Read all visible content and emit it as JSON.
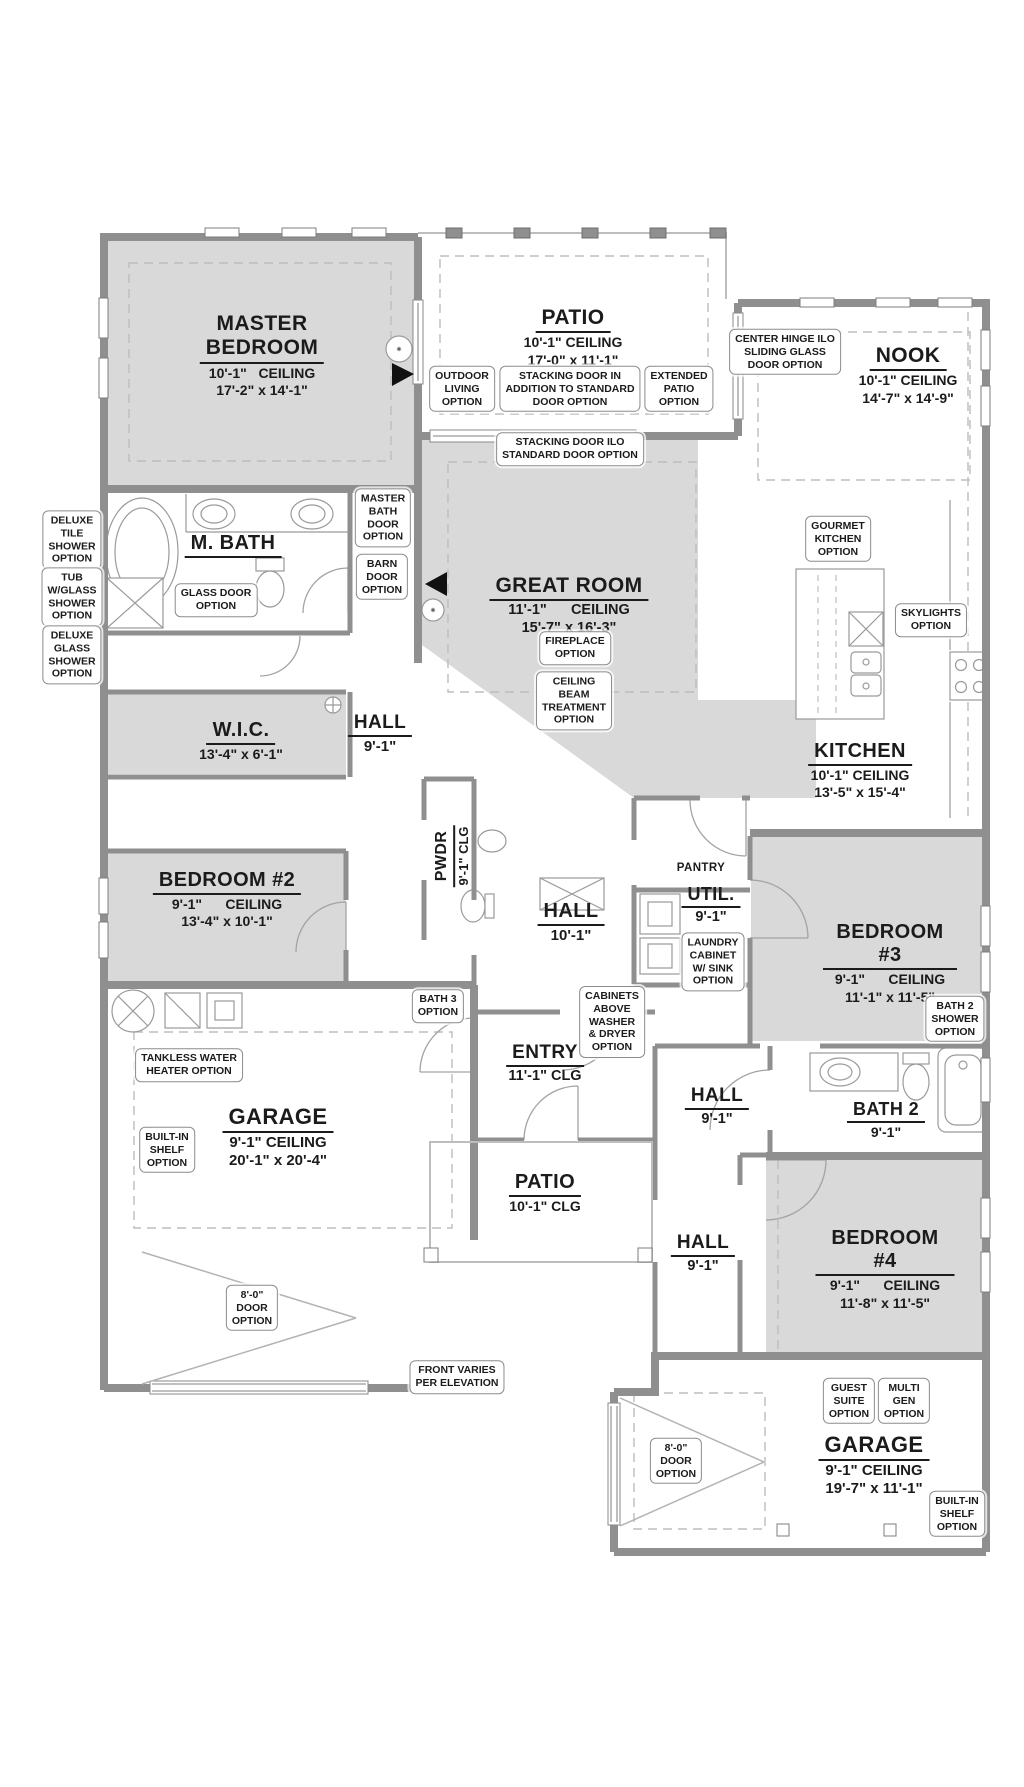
{
  "colors": {
    "wall": "#8f8f8f",
    "room_fill": "#d9d9d9",
    "dash": "#bdbdbd",
    "text": "#1b1b1b"
  },
  "plan": {
    "rooms": [
      {
        "id": "master-bedroom",
        "title": "MASTER\nBEDROOM",
        "lines": [
          "10'-1\"   CEILING",
          "17'-2\" x 14'-1\""
        ]
      },
      {
        "id": "patio-top",
        "title": "PATIO",
        "lines": [
          "10'-1\" CEILING",
          "17'-0\" x 11'-1\""
        ]
      },
      {
        "id": "nook",
        "title": "NOOK",
        "lines": [
          "10'-1\" CEILING",
          "14'-7\" x 14'-9\""
        ]
      },
      {
        "id": "m-bath",
        "title": "M. BATH",
        "lines": []
      },
      {
        "id": "great-room",
        "title": "GREAT ROOM",
        "lines": [
          "11'-1\"      CEILING",
          "15'-7\" x 16'-3\""
        ]
      },
      {
        "id": "kitchen",
        "title": "KITCHEN",
        "lines": [
          "10'-1\" CEILING",
          "13'-5\" x 15'-4\""
        ]
      },
      {
        "id": "wic",
        "title": "W.I.C.",
        "lines": [
          "13'-4\" x 6'-1\""
        ]
      },
      {
        "id": "hall-upper",
        "title": "HALL",
        "lines": [
          "9'-1\""
        ]
      },
      {
        "id": "bedroom-2",
        "title": "BEDROOM #2",
        "lines": [
          "9'-1\"      CEILING",
          "13'-4\" x 10'-1\""
        ]
      },
      {
        "id": "pwdr",
        "title": "PWDR",
        "lines": [
          "9'-1\" CLG"
        ],
        "rot": true
      },
      {
        "id": "hall-center",
        "title": "HALL",
        "lines": [
          "10'-1\""
        ]
      },
      {
        "id": "pantry",
        "title": "PANTRY",
        "lines": [],
        "plain": true
      },
      {
        "id": "util",
        "title": "UTIL.",
        "lines": [
          "9'-1\""
        ]
      },
      {
        "id": "bedroom-3",
        "title": "BEDROOM #3",
        "lines": [
          "9'-1\"      CEILING",
          "11'-1\" x 11'-5\""
        ]
      },
      {
        "id": "garage-main",
        "title": "GARAGE",
        "lines": [
          "9'-1\" CEILING",
          "20'-1\" x 20'-4\""
        ]
      },
      {
        "id": "entry",
        "title": "ENTRY",
        "lines": [
          "11'-1\" CLG"
        ]
      },
      {
        "id": "hall-bath2",
        "title": "HALL",
        "lines": [
          "9'-1\""
        ]
      },
      {
        "id": "bath-2",
        "title": "BATH 2",
        "lines": [
          "9'-1\""
        ]
      },
      {
        "id": "patio-front",
        "title": "PATIO",
        "lines": [
          "10'-1\" CLG"
        ]
      },
      {
        "id": "hall-bedroom4",
        "title": "HALL",
        "lines": [
          "9'-1\""
        ]
      },
      {
        "id": "bedroom-4",
        "title": "BEDROOM #4",
        "lines": [
          "9'-1\"      CEILING",
          "11'-8\" x 11'-5\""
        ]
      },
      {
        "id": "garage-rear",
        "title": "GARAGE",
        "lines": [
          "9'-1\" CEILING",
          "19'-7\" x 11'-1\""
        ]
      }
    ],
    "callouts": [
      {
        "id": "outdoor-living",
        "text": "OUTDOOR\nLIVING\nOPTION"
      },
      {
        "id": "stacking-door-addition",
        "text": "STACKING DOOR IN\nADDITION TO STANDARD\nDOOR OPTION"
      },
      {
        "id": "extended-patio",
        "text": "EXTENDED\nPATIO\nOPTION"
      },
      {
        "id": "center-hinge",
        "text": "CENTER HINGE ILO\nSLIDING GLASS\nDOOR OPTION"
      },
      {
        "id": "stacking-door-ilo",
        "text": "STACKING DOOR ILO\nSTANDARD DOOR OPTION"
      },
      {
        "id": "deluxe-tile-shower",
        "text": "DELUXE\nTILE\nSHOWER\nOPTION"
      },
      {
        "id": "tub-glass-shower",
        "text": "TUB\nW/GLASS\nSHOWER\nOPTION"
      },
      {
        "id": "deluxe-glass-shower",
        "text": "DELUXE\nGLASS\nSHOWER\nOPTION"
      },
      {
        "id": "master-bath-door",
        "text": "MASTER\nBATH\nDOOR\nOPTION"
      },
      {
        "id": "barn-door",
        "text": "BARN\nDOOR\nOPTION"
      },
      {
        "id": "glass-door",
        "text": "GLASS DOOR\nOPTION"
      },
      {
        "id": "gourmet-kitchen",
        "text": "GOURMET\nKITCHEN\nOPTION"
      },
      {
        "id": "skylights",
        "text": "SKYLIGHTS\nOPTION"
      },
      {
        "id": "fireplace",
        "text": "FIREPLACE\nOPTION"
      },
      {
        "id": "ceiling-beam",
        "text": "CEILING\nBEAM\nTREATMENT\nOPTION"
      },
      {
        "id": "laundry-cabinet",
        "text": "LAUNDRY\nCABINET\nW/ SINK\nOPTION"
      },
      {
        "id": "cabinets-above",
        "text": "CABINETS\nABOVE\nWASHER\n& DRYER\nOPTION"
      },
      {
        "id": "bath3",
        "text": "BATH 3\nOPTION"
      },
      {
        "id": "bath2-shower",
        "text": "BATH 2\nSHOWER\nOPTION"
      },
      {
        "id": "tankless",
        "text": "TANKLESS WATER\nHEATER OPTION"
      },
      {
        "id": "builtin-shelf-main",
        "text": "BUILT-IN\nSHELF\nOPTION"
      },
      {
        "id": "door-8-main",
        "text": "8'-0\"\nDOOR\nOPTION"
      },
      {
        "id": "front-varies",
        "text": "FRONT VARIES\nPER ELEVATION"
      },
      {
        "id": "guest-suite",
        "text": "GUEST\nSUITE\nOPTION"
      },
      {
        "id": "multi-gen",
        "text": "MULTI\nGEN\nOPTION"
      },
      {
        "id": "door-8-rear",
        "text": "8'-0\"\nDOOR\nOPTION"
      },
      {
        "id": "builtin-shelf-rear",
        "text": "BUILT-IN\nSHELF\nOPTION"
      }
    ]
  }
}
